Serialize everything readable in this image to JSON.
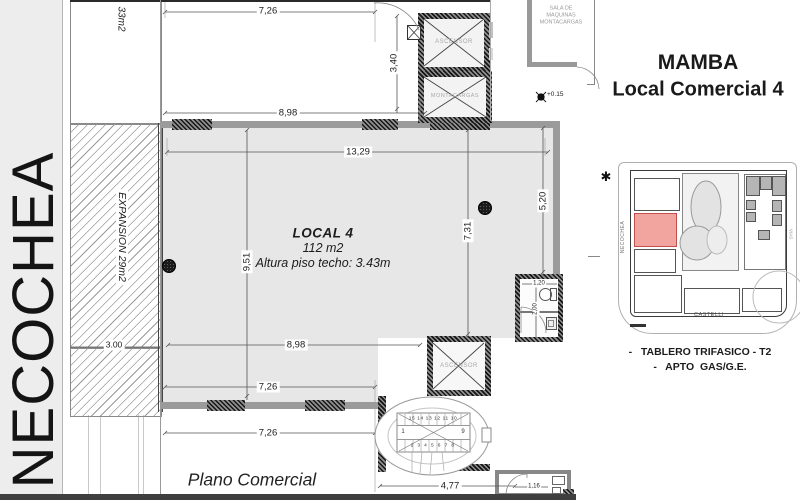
{
  "colors": {
    "highlight_unit": "#f2a49e",
    "highlight_border": "#c0504d",
    "interior_gray": "#e7e7e7",
    "sidewalk_gray": "#ededed",
    "wall_gray": "#9b9b9b"
  },
  "street": {
    "name": "NECOCHEA"
  },
  "plan": {
    "caption": "Plano Comercial",
    "local": {
      "name": "LOCAL  4",
      "area": "112 m2",
      "height": "Altura piso techo: 3.43m"
    },
    "expansion": {
      "label": "EXPANSION 29m2",
      "upper_label": "33m2"
    },
    "rooms": {
      "ascensor_top": "ASCENSOR",
      "montacargas": "MONTACARGAS",
      "ascensor_bottom": "ASCENSOR",
      "sala_line1": "SALA DE",
      "sala_line2": "MAQUINAS",
      "sala_line3": "MONTACARGAS"
    },
    "level_marker": "+0.15",
    "dims": {
      "d726_top": "7,26",
      "d898_top": "8,98",
      "d340": "3,40",
      "d1329": "13,29",
      "d951": "9,51",
      "d731": "7,31",
      "d520": "5,20",
      "d898_bottom": "8,98",
      "d726_mid": "7,26",
      "d726_low": "7,26",
      "d300": "3.00",
      "d477": "4,77",
      "d116": "1,16",
      "d120": "1,20",
      "d200": "2,00"
    },
    "stairs": {
      "top_row": "15 14 13 12 11 10",
      "start": "1",
      "end": "9",
      "bottom_row": "2 3 4 5 6 7 8"
    }
  },
  "panel": {
    "title_line1": "MAMBA",
    "title_line2": "Local Comercial 4",
    "north_marker": "✱",
    "keyplan": {
      "street_left": "NECOCHEA",
      "street_bottom": "CASTELLI",
      "street_right": "VIAS"
    },
    "notes": {
      "line1": "-   TABLERO TRIFASICO - T2",
      "line2": "-   APTO  GAS/G.E."
    }
  }
}
